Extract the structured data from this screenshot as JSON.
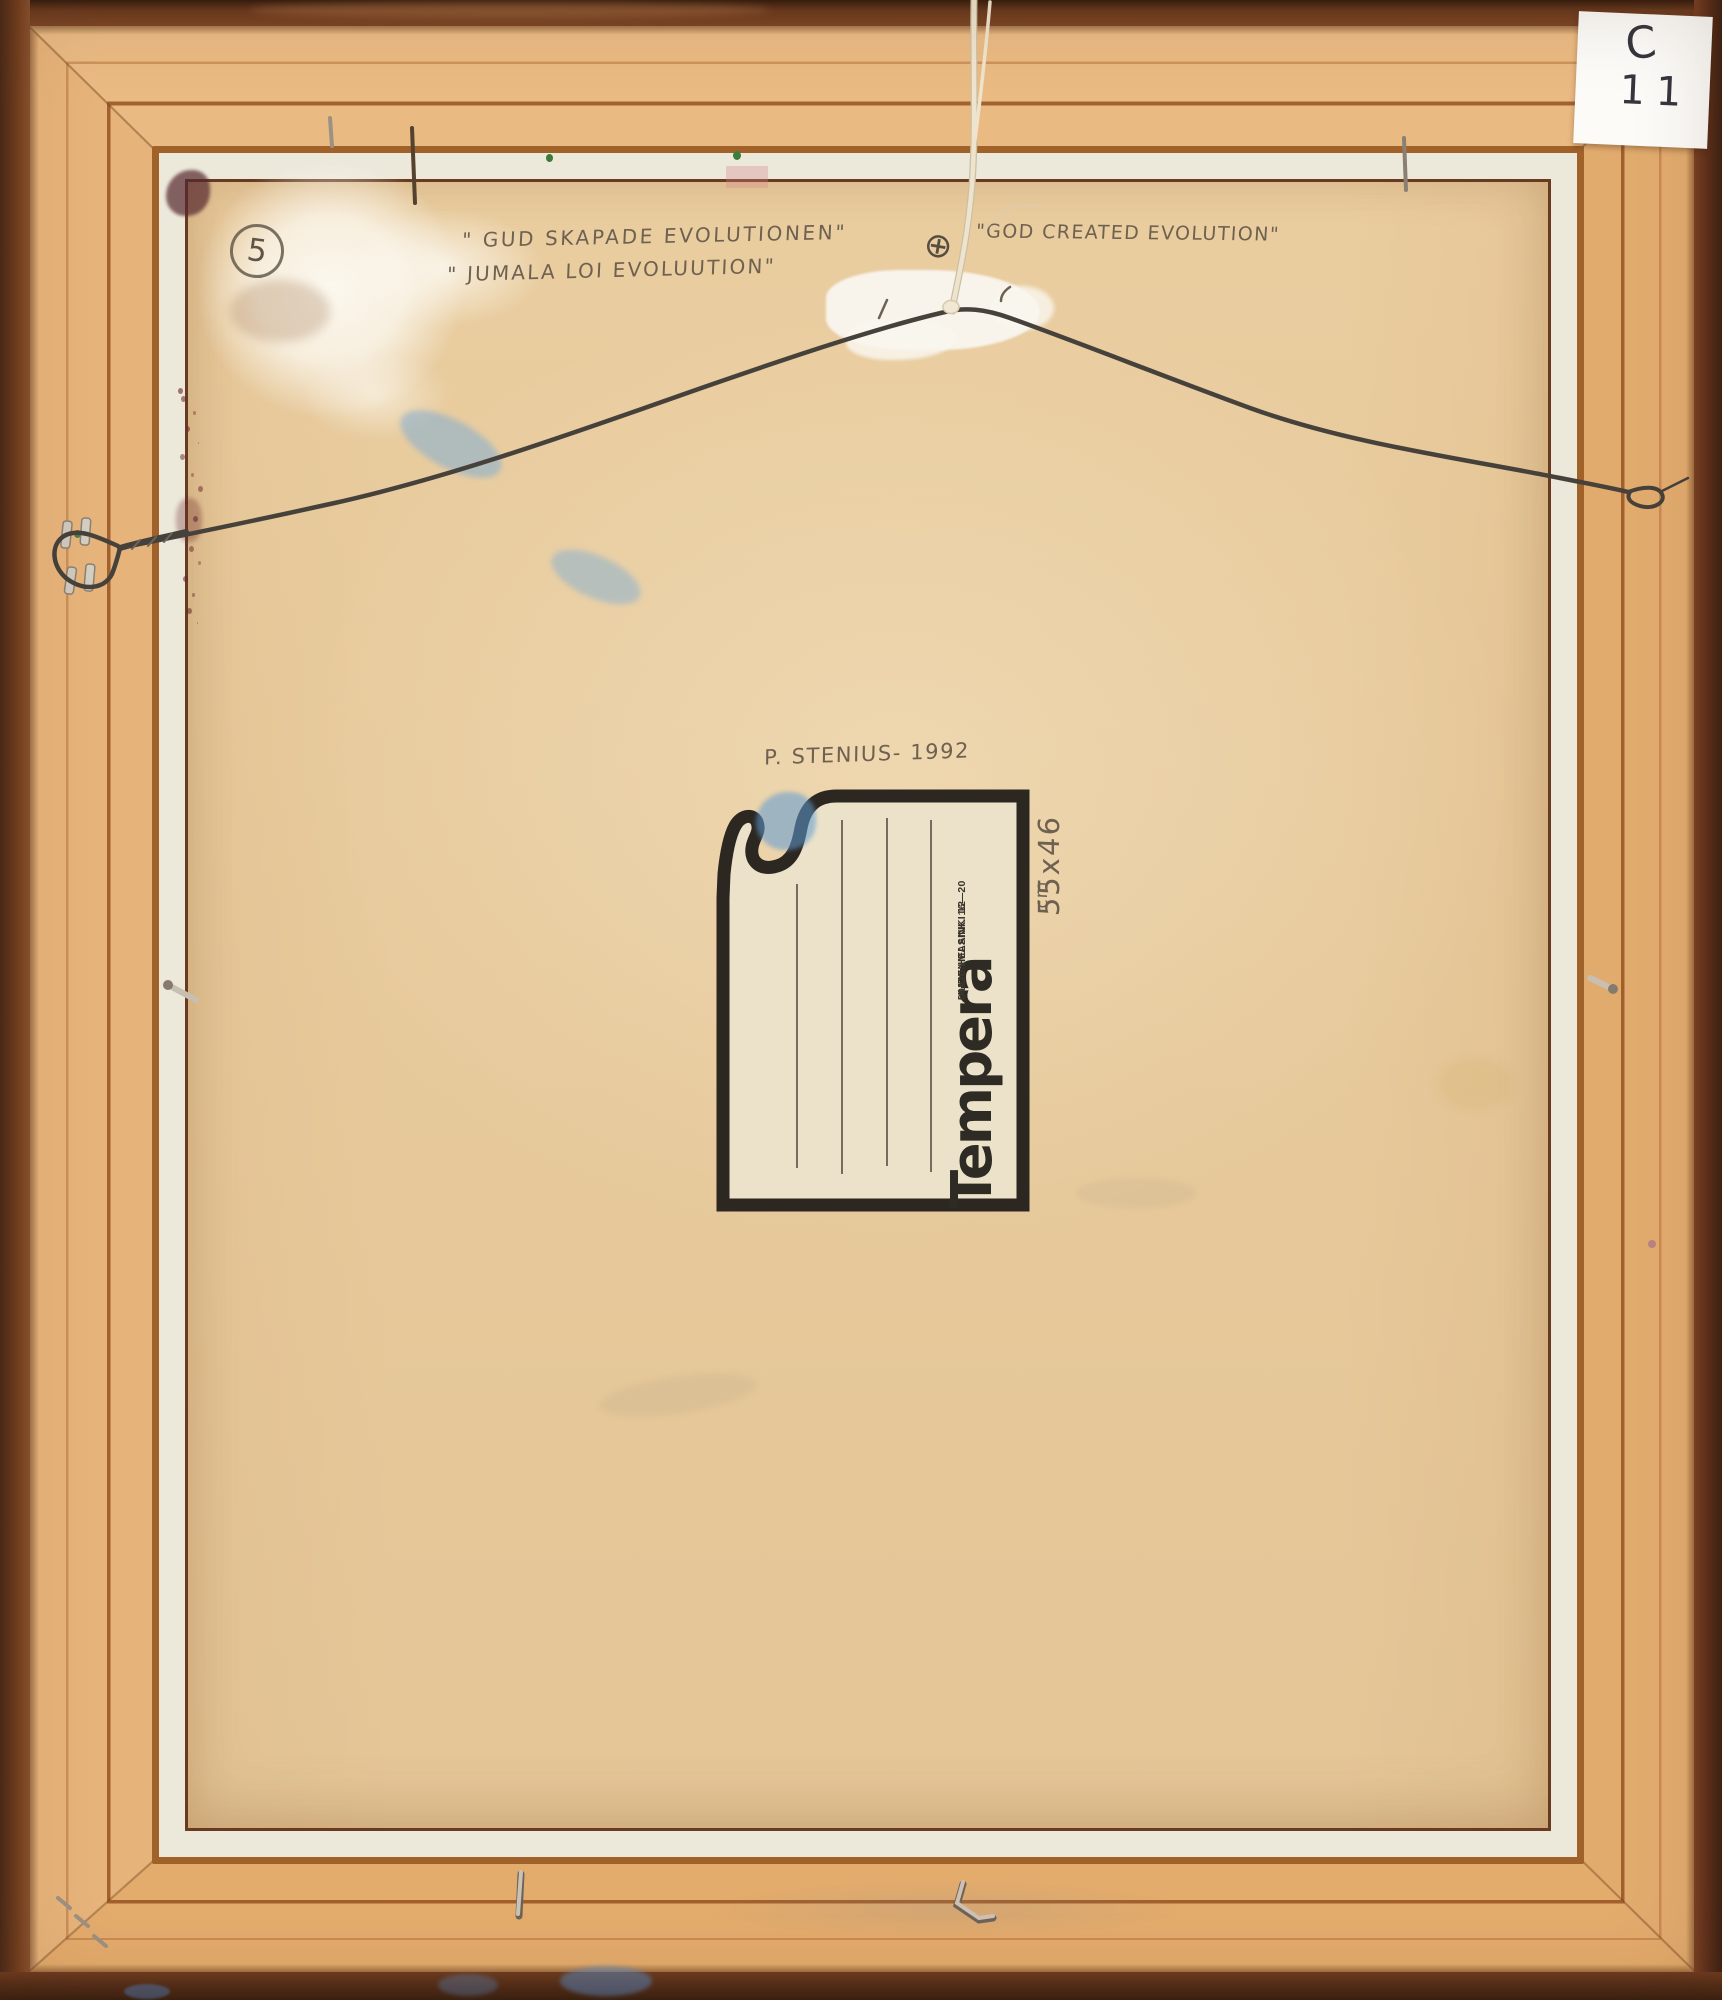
{
  "inscriptions": {
    "title_swedish": "\" GUD SKAPADE EVOLUTIONEN\"",
    "title_finnish": "\" JUMALA LOI EVOLUUTION\"",
    "title_english": "\"GOD CREATED EVOLUTION\"",
    "signature": "P. STENIUS- 1992",
    "size": "55x46",
    "size_unit": "cm",
    "corner_number": "5"
  },
  "supplier_label": {
    "brand": "Tempera",
    "address_line1": "UUDENMAANK. 16—20",
    "address_line2": "00120 HELSINKI 12"
  },
  "inventory_tag": {
    "line1": "C",
    "line2": "11"
  },
  "icons": {
    "registration_mark_icon": "⊕"
  },
  "colors": {
    "frame_edge": "#66371f",
    "frame_wood": "#e8b67e",
    "liner_white": "#ece8da",
    "backing": "#ecd2a6",
    "label_ink": "#2c2721",
    "pencil": "#6f6150",
    "wire": "#46413b",
    "string": "#eee4cd",
    "smudge_blue": "#78aad7",
    "stain_maroon": "#682830",
    "paint_white": "#faf7ef"
  }
}
